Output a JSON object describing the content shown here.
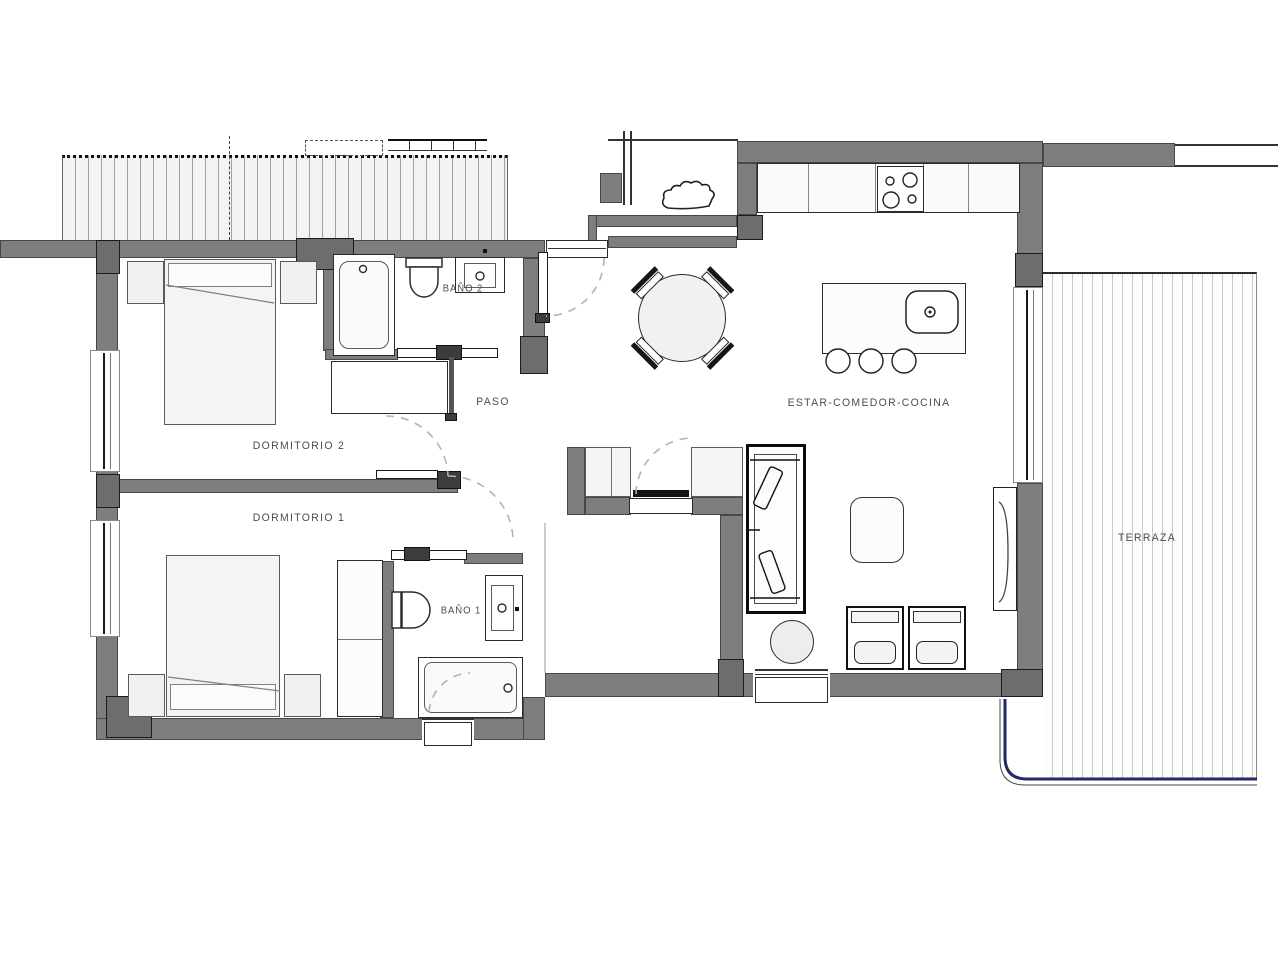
{
  "rooms": {
    "dormitorio2": {
      "label": "DORMITORIO 2"
    },
    "dormitorio1": {
      "label": "DORMITORIO 1"
    },
    "bano2": {
      "label": "BAÑO 2"
    },
    "bano1": {
      "label": "BAÑO 1"
    },
    "paso": {
      "label": "PASO"
    },
    "estar": {
      "label": "ESTAR-COMEDOR-COCINA"
    },
    "terraza": {
      "label": "TERRAZA"
    }
  },
  "colors": {
    "wall": "#7e7e7e",
    "wall_dark": "#6d6d6d",
    "wall_edge": "#474747",
    "line": "#2b2b2b",
    "fill": "#f1f1f1",
    "hatch_line": "#c8c8c8",
    "hatch_bg": "#fdfdfd",
    "pergola_line": "#9f9f9f",
    "pergola_bg": "#f3f3f3",
    "railing_navy": "#232a63",
    "arc_dash": "#b3b3b3",
    "label": "#4c4c4c"
  }
}
